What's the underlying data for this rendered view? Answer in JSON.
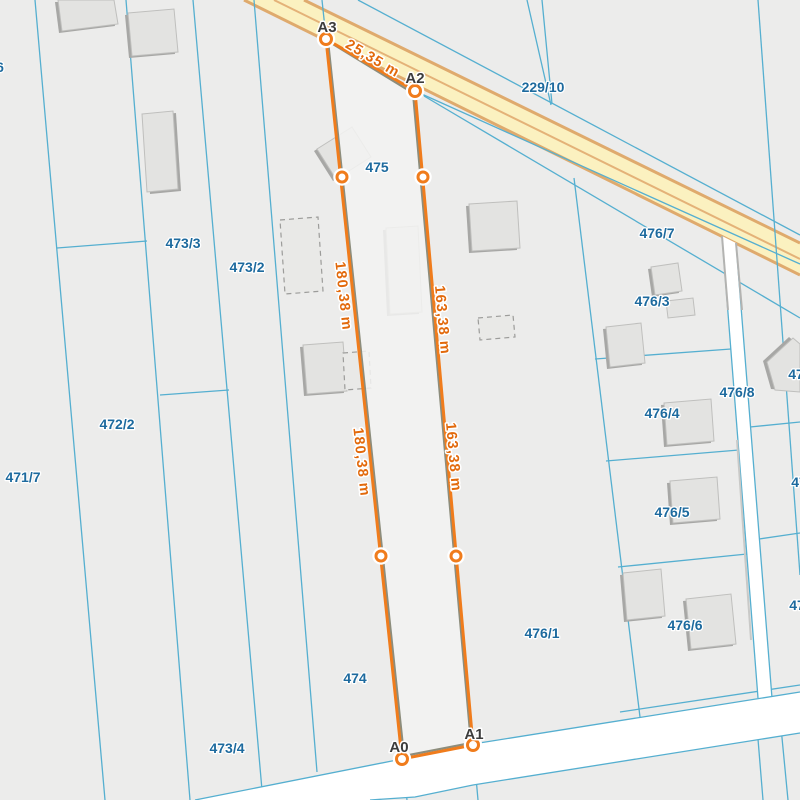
{
  "map_type": "cadastral-parcel-map",
  "parcels": [
    {
      "label": "473/3"
    },
    {
      "label": "473/2"
    },
    {
      "label": "472/2"
    },
    {
      "label": "471/7"
    },
    {
      "label": "6"
    },
    {
      "label": "473/4"
    },
    {
      "label": "474"
    },
    {
      "label": "475"
    },
    {
      "label": "229/10"
    },
    {
      "label": "476/7"
    },
    {
      "label": "476/3"
    },
    {
      "label": "476/4"
    },
    {
      "label": "476/8"
    },
    {
      "label": "476/5"
    },
    {
      "label": "476/6"
    },
    {
      "label": "476/1"
    },
    {
      "label": "47"
    },
    {
      "label": "47"
    },
    {
      "label": "47"
    }
  ],
  "measurement": {
    "vertices": [
      {
        "label": "A3"
      },
      {
        "label": "A2"
      },
      {
        "label": "A0"
      },
      {
        "label": "A1"
      }
    ],
    "distances": [
      {
        "label": "25,35 m"
      },
      {
        "label": "180,38 m"
      },
      {
        "label": "180,38 m"
      },
      {
        "label": "163,38 m"
      },
      {
        "label": "163,38 m"
      }
    ]
  },
  "colors": {
    "background": "#ececeb",
    "parcel_line": "#55afd0",
    "parcel_label": "#1d6a9e",
    "road_fill": "#fbf1c0",
    "road_border": "#dfaa6d",
    "side_road_fill": "#ffffff",
    "building_fill": "#e3e3e1",
    "building_shadow": "#a7a7a5",
    "measure_line_orange": "#f07c1c",
    "measure_line_gray": "#8d8d7c",
    "measure_label": "#e2690b",
    "vertex_label": "#3c3c3c"
  }
}
